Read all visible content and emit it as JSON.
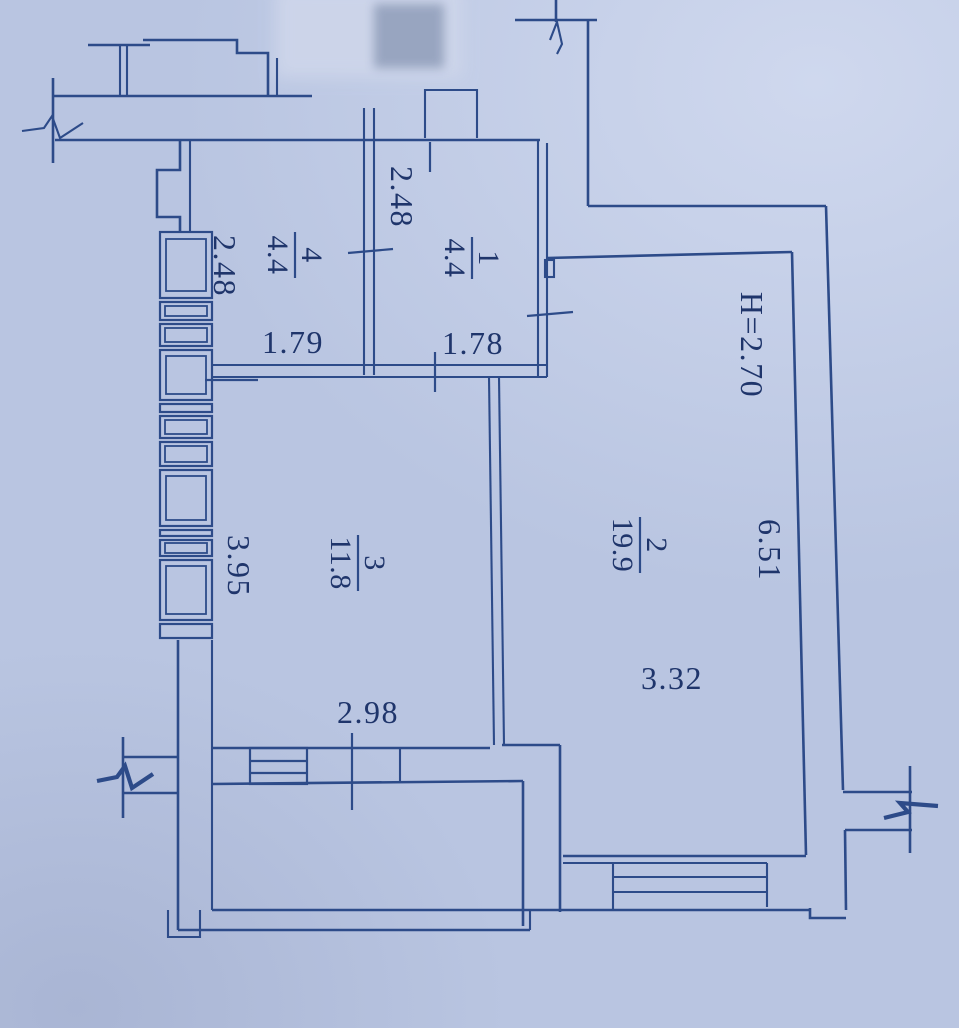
{
  "colors": {
    "paper": "#b9c5e1",
    "ink": "#2d4b89",
    "text": "#1f356b",
    "blur_light": "#cdd5ea",
    "blur_dark": "#93a0bc"
  },
  "rooms": [
    {
      "number": "1",
      "area": "4.4"
    },
    {
      "number": "2",
      "area": "19.9"
    },
    {
      "number": "3",
      "area": "11.8"
    },
    {
      "number": "4",
      "area": "4.4"
    }
  ],
  "dimensions": {
    "room1_top_width": "2.48",
    "left_top_width": "2.48",
    "room4_width": "1.79",
    "room1_width": "1.78",
    "ceiling_height": "H=2.70",
    "left_height": "3.95",
    "room2_length": "6.51",
    "room2_width": "3.32",
    "bottom_opening_width": "2.98"
  }
}
